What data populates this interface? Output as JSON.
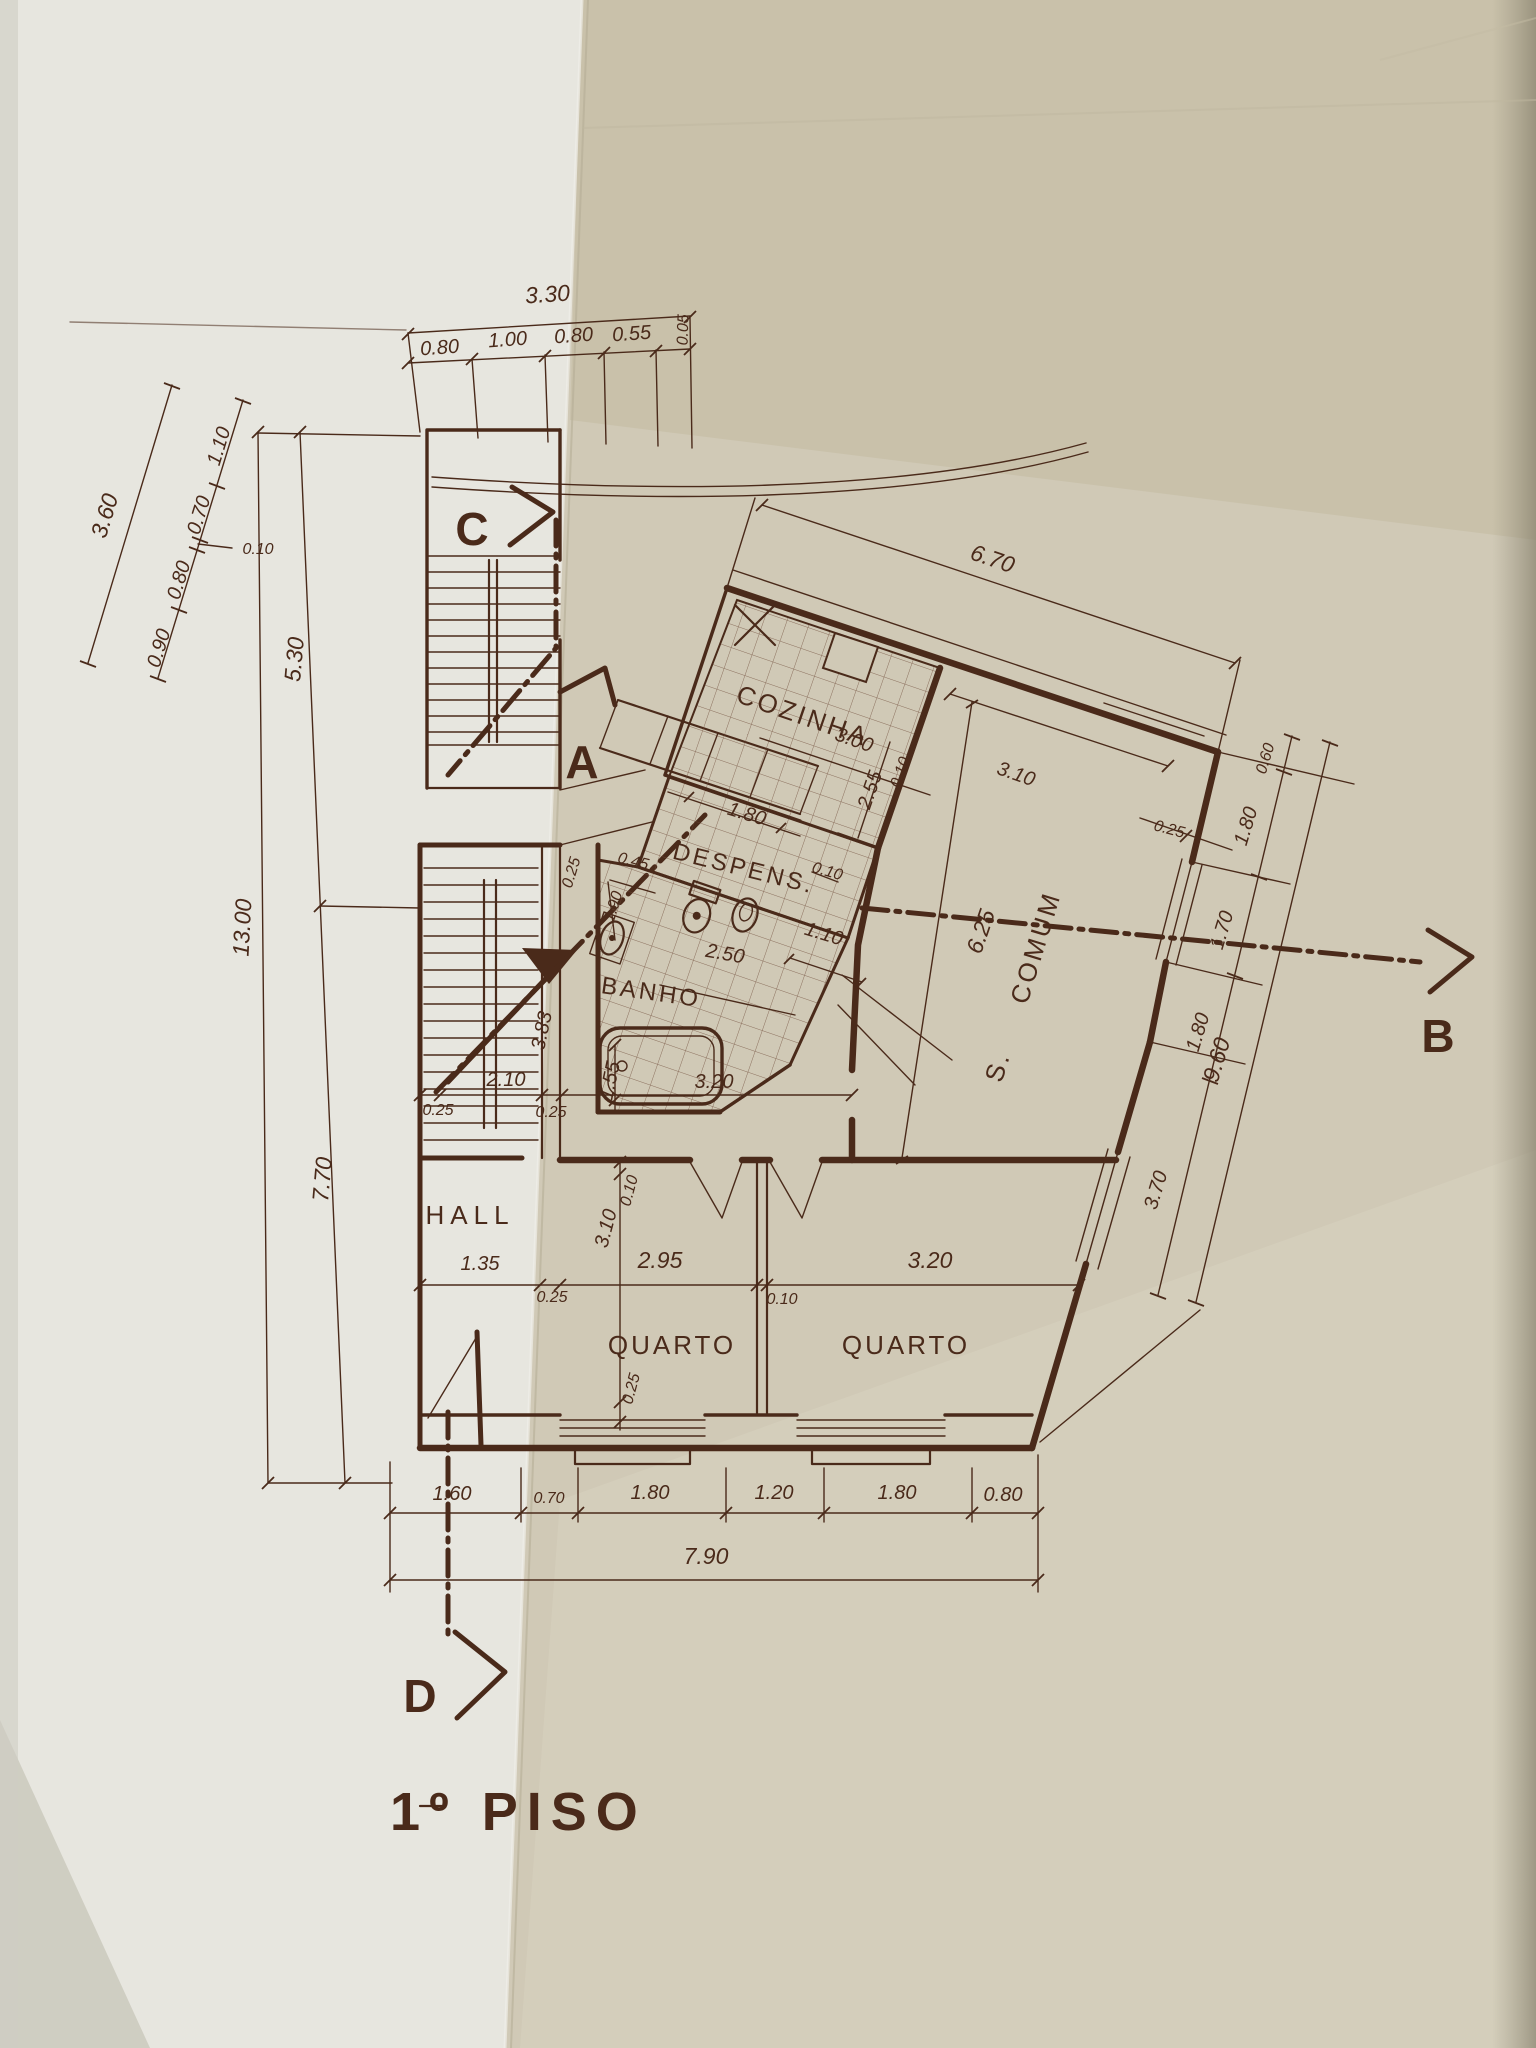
{
  "title": "1º PISO",
  "markers": {
    "c": "C",
    "a": "A",
    "b": "B",
    "d": "D"
  },
  "rooms": {
    "kitchen": "COZINHA",
    "pantry": "DESPENS.",
    "bath": "BANHO",
    "living_prefix": "S.",
    "living": "COMUM",
    "hall": "HALL",
    "bedroom1": "QUARTO",
    "bedroom2": "QUARTO"
  },
  "dims": {
    "top": [
      "3.30",
      "0.80",
      "1.00",
      "0.80",
      "0.55",
      "0.05"
    ],
    "left_diag": [
      "3.60",
      "1.10",
      "0.70",
      "0.10",
      "0.80",
      "0.90"
    ],
    "left_vert": [
      "13.00",
      "5.30",
      "7.70"
    ],
    "kitchen": [
      "6.70",
      "3.00",
      "2.55",
      "0.10",
      "3.10",
      "0.25"
    ],
    "mid": [
      "0.25",
      "1.80",
      "0.45",
      "1.90",
      "0.10",
      "1.10",
      "2.50",
      "6.25",
      "0.25",
      "3.83",
      "2.10",
      "0.25",
      "1.55",
      "3.20"
    ],
    "beds": [
      "1.35",
      "0.25",
      "2.95",
      "0.10",
      "3.20",
      "0.10",
      "3.10",
      "0.25"
    ],
    "right": [
      "0.60",
      "1.80",
      "1.70",
      "1.80",
      "3.70",
      "9.60"
    ],
    "bottom": [
      "1.60",
      "0.70",
      "1.80",
      "1.20",
      "1.80",
      "0.80",
      "7.90"
    ]
  }
}
